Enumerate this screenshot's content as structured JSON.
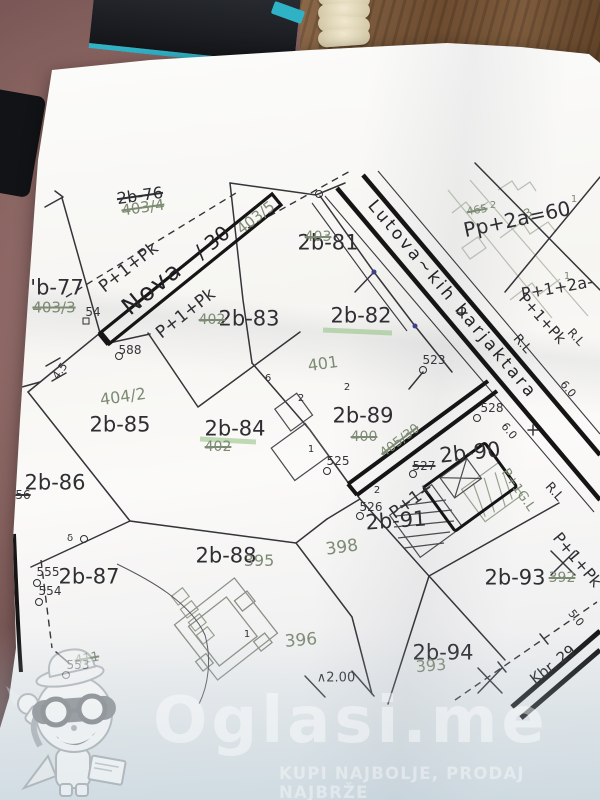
{
  "palette": {
    "paper": "#f7f6f3",
    "ink": "#2e2e33",
    "old_ink": "#7d8a74",
    "bold_ink": "#141414",
    "table": "#84605f",
    "wood": "#7a583a",
    "teal": "#2fb2c6",
    "survey_dot": "#3d3f8f",
    "highlight": "#8fbf7f"
  },
  "map": {
    "parcels": [
      {
        "t": "'b-77",
        "x": 57,
        "y": 288
      },
      {
        "t": "2b-76",
        "x": 140,
        "y": 196,
        "rot": -8,
        "size": 16,
        "struck": true
      },
      {
        "t": "2b-81",
        "x": 328,
        "y": 243
      },
      {
        "t": "2b-82",
        "x": 361,
        "y": 316
      },
      {
        "t": "2b-83",
        "x": 249,
        "y": 319
      },
      {
        "t": "2b-84",
        "x": 235,
        "y": 429
      },
      {
        "t": "2b-85",
        "x": 120,
        "y": 425
      },
      {
        "t": "2b-86",
        "x": 55,
        "y": 483
      },
      {
        "t": "2b-87",
        "x": 89,
        "y": 577
      },
      {
        "t": "2b-88",
        "x": 226,
        "y": 556
      },
      {
        "t": "2b-89",
        "x": 363,
        "y": 416
      },
      {
        "t": "2b-90",
        "x": 470,
        "y": 453,
        "rot": -6
      },
      {
        "t": "2b-91",
        "x": 396,
        "y": 521,
        "rot": -4
      },
      {
        "t": "2b-93",
        "x": 515,
        "y": 578
      },
      {
        "t": "2b-94",
        "x": 443,
        "y": 653
      }
    ],
    "roads": [
      {
        "t": "Nova",
        "x": 152,
        "y": 288,
        "rot": -39,
        "size": 24,
        "ls": 2
      },
      {
        "t": "/ 30",
        "x": 212,
        "y": 242,
        "rot": -39,
        "size": 20
      },
      {
        "t": "Lutova~kih barjaktara",
        "x": 452,
        "y": 300,
        "rot": 50,
        "size": 17,
        "ls": 3
      },
      {
        "t": "Kbr. 29",
        "x": 553,
        "y": 665,
        "rot": -38,
        "size": 15
      }
    ],
    "annotations": [
      {
        "t": "P+1+Pk",
        "x": 129,
        "y": 268,
        "rot": -38,
        "size": 17
      },
      {
        "t": "P+1+Pk",
        "x": 186,
        "y": 314,
        "rot": -38,
        "size": 17
      },
      {
        "t": "Pp+2a=60",
        "x": 517,
        "y": 219,
        "rot": -12,
        "size": 20
      },
      {
        "t": "P+1+2a-",
        "x": 557,
        "y": 288,
        "rot": -10,
        "size": 16
      },
      {
        "t": "P+1+Pk",
        "x": 542,
        "y": 319,
        "rot": 48,
        "size": 15
      },
      {
        "t": "P+1+",
        "x": 412,
        "y": 501,
        "rot": -36,
        "size": 17
      },
      {
        "t": "P+1+Pk",
        "x": 577,
        "y": 560,
        "rot": 50,
        "size": 16
      },
      {
        "t": "R.L",
        "x": 522,
        "y": 344,
        "rot": 48,
        "size": 13
      },
      {
        "t": "R.L",
        "x": 576,
        "y": 337,
        "rot": 48,
        "size": 12
      },
      {
        "t": "R.L",
        "x": 554,
        "y": 492,
        "rot": 48,
        "size": 13
      },
      {
        "t": "6.0",
        "x": 568,
        "y": 389,
        "rot": 50,
        "size": 11
      },
      {
        "t": "6.0",
        "x": 509,
        "y": 431,
        "rot": 50,
        "size": 11
      },
      {
        "t": "5.0",
        "x": 576,
        "y": 618,
        "rot": 50,
        "size": 11
      },
      {
        "t": "4.5",
        "x": 60,
        "y": 371,
        "rot": -55,
        "size": 11
      },
      {
        "t": "∧2.00",
        "x": 336,
        "y": 678,
        "size": 13
      },
      {
        "t": "6",
        "x": 268,
        "y": 379,
        "size": 10
      },
      {
        "t": "2",
        "x": 301,
        "y": 399,
        "size": 10
      },
      {
        "t": "2",
        "x": 347,
        "y": 388,
        "size": 10
      },
      {
        "t": "2",
        "x": 377,
        "y": 491,
        "size": 10
      },
      {
        "t": "1",
        "x": 247,
        "y": 635,
        "size": 10
      },
      {
        "t": "1",
        "x": 311,
        "y": 450,
        "size": 10
      },
      {
        "t": "δ",
        "x": 70,
        "y": 539,
        "size": 10
      }
    ],
    "old_parcels": [
      {
        "t": "403/4",
        "x": 143,
        "y": 208,
        "rot": -8,
        "struck": true
      },
      {
        "t": "403/5",
        "x": 256,
        "y": 218,
        "rot": -38
      },
      {
        "t": "403/3",
        "x": 54,
        "y": 308,
        "struck": true
      },
      {
        "t": "403",
        "x": 318,
        "y": 237,
        "struck": true,
        "size": 14
      },
      {
        "t": "402",
        "x": 212,
        "y": 320,
        "struck": true,
        "size": 14
      },
      {
        "t": "401",
        "x": 323,
        "y": 364,
        "rot": -8,
        "size": 16
      },
      {
        "t": "404/2",
        "x": 123,
        "y": 397,
        "rot": -8,
        "size": 16
      },
      {
        "t": "400",
        "x": 364,
        "y": 437,
        "struck": true,
        "size": 14
      },
      {
        "t": "402",
        "x": 218,
        "y": 447,
        "struck": true,
        "size": 14
      },
      {
        "t": "405/30",
        "x": 400,
        "y": 441,
        "rot": -37,
        "struck": true,
        "size": 13
      },
      {
        "t": "395",
        "x": 259,
        "y": 561,
        "size": 16
      },
      {
        "t": "398",
        "x": 342,
        "y": 548,
        "rot": -8,
        "size": 17
      },
      {
        "t": "396",
        "x": 301,
        "y": 641,
        "rot": -5,
        "size": 17
      },
      {
        "t": "393",
        "x": 431,
        "y": 666,
        "rot": -5,
        "size": 16
      },
      {
        "t": "392",
        "x": 562,
        "y": 578,
        "struck": true,
        "size": 14
      },
      {
        "t": "411",
        "x": 87,
        "y": 659,
        "rot": -10,
        "struck": true,
        "size": 13
      },
      {
        "t": "465",
        "x": 477,
        "y": 210,
        "rot": -10,
        "struck": true,
        "size": 11
      },
      {
        "t": "3",
        "x": 528,
        "y": 213,
        "rot": -30,
        "size": 12
      },
      {
        "t": "2",
        "x": 493,
        "y": 206,
        "size": 10
      },
      {
        "t": "1",
        "x": 574,
        "y": 200,
        "size": 10
      },
      {
        "t": "1",
        "x": 567,
        "y": 277,
        "size": 10
      },
      {
        "t": "P+1G.L",
        "x": 518,
        "y": 490,
        "rot": 55,
        "size": 13
      }
    ],
    "survey_points": [
      {
        "t": "54",
        "x": 93,
        "y": 312
      },
      {
        "t": "588",
        "x": 130,
        "y": 350
      },
      {
        "t": "523",
        "x": 434,
        "y": 360
      },
      {
        "t": "525",
        "x": 338,
        "y": 461
      },
      {
        "t": "526",
        "x": 371,
        "y": 507
      },
      {
        "t": "527",
        "x": 424,
        "y": 466,
        "struck": true
      },
      {
        "t": "528",
        "x": 492,
        "y": 408
      },
      {
        "t": "555",
        "x": 48,
        "y": 572
      },
      {
        "t": "554",
        "x": 50,
        "y": 591
      },
      {
        "t": "553",
        "x": 78,
        "y": 665
      },
      {
        "t": "56",
        "x": 23,
        "y": 495,
        "struck": true
      }
    ],
    "symbols": [
      {
        "k": "square",
        "x": 86,
        "y": 321
      },
      {
        "k": "circle",
        "x": 119,
        "y": 356
      },
      {
        "k": "circle",
        "x": 423,
        "y": 370
      },
      {
        "k": "circle",
        "x": 327,
        "y": 471
      },
      {
        "k": "circle",
        "x": 360,
        "y": 516
      },
      {
        "k": "circle",
        "x": 413,
        "y": 474
      },
      {
        "k": "circle",
        "x": 477,
        "y": 418
      },
      {
        "k": "circle",
        "x": 37,
        "y": 583
      },
      {
        "k": "circle",
        "x": 39,
        "y": 602
      },
      {
        "k": "circle",
        "x": 66,
        "y": 675
      },
      {
        "k": "circle",
        "x": 84,
        "y": 539
      },
      {
        "k": "circle",
        "x": 319,
        "y": 194
      },
      {
        "k": "dot",
        "x": 374,
        "y": 272
      },
      {
        "k": "dot",
        "x": 415,
        "y": 326
      }
    ]
  },
  "watermark": {
    "brand": "Oglasi.me",
    "tagline": "KUPI NAJBOLJE, PRODAJ NAJBRŽE",
    "mascot": "bandit-mascot-icon"
  }
}
